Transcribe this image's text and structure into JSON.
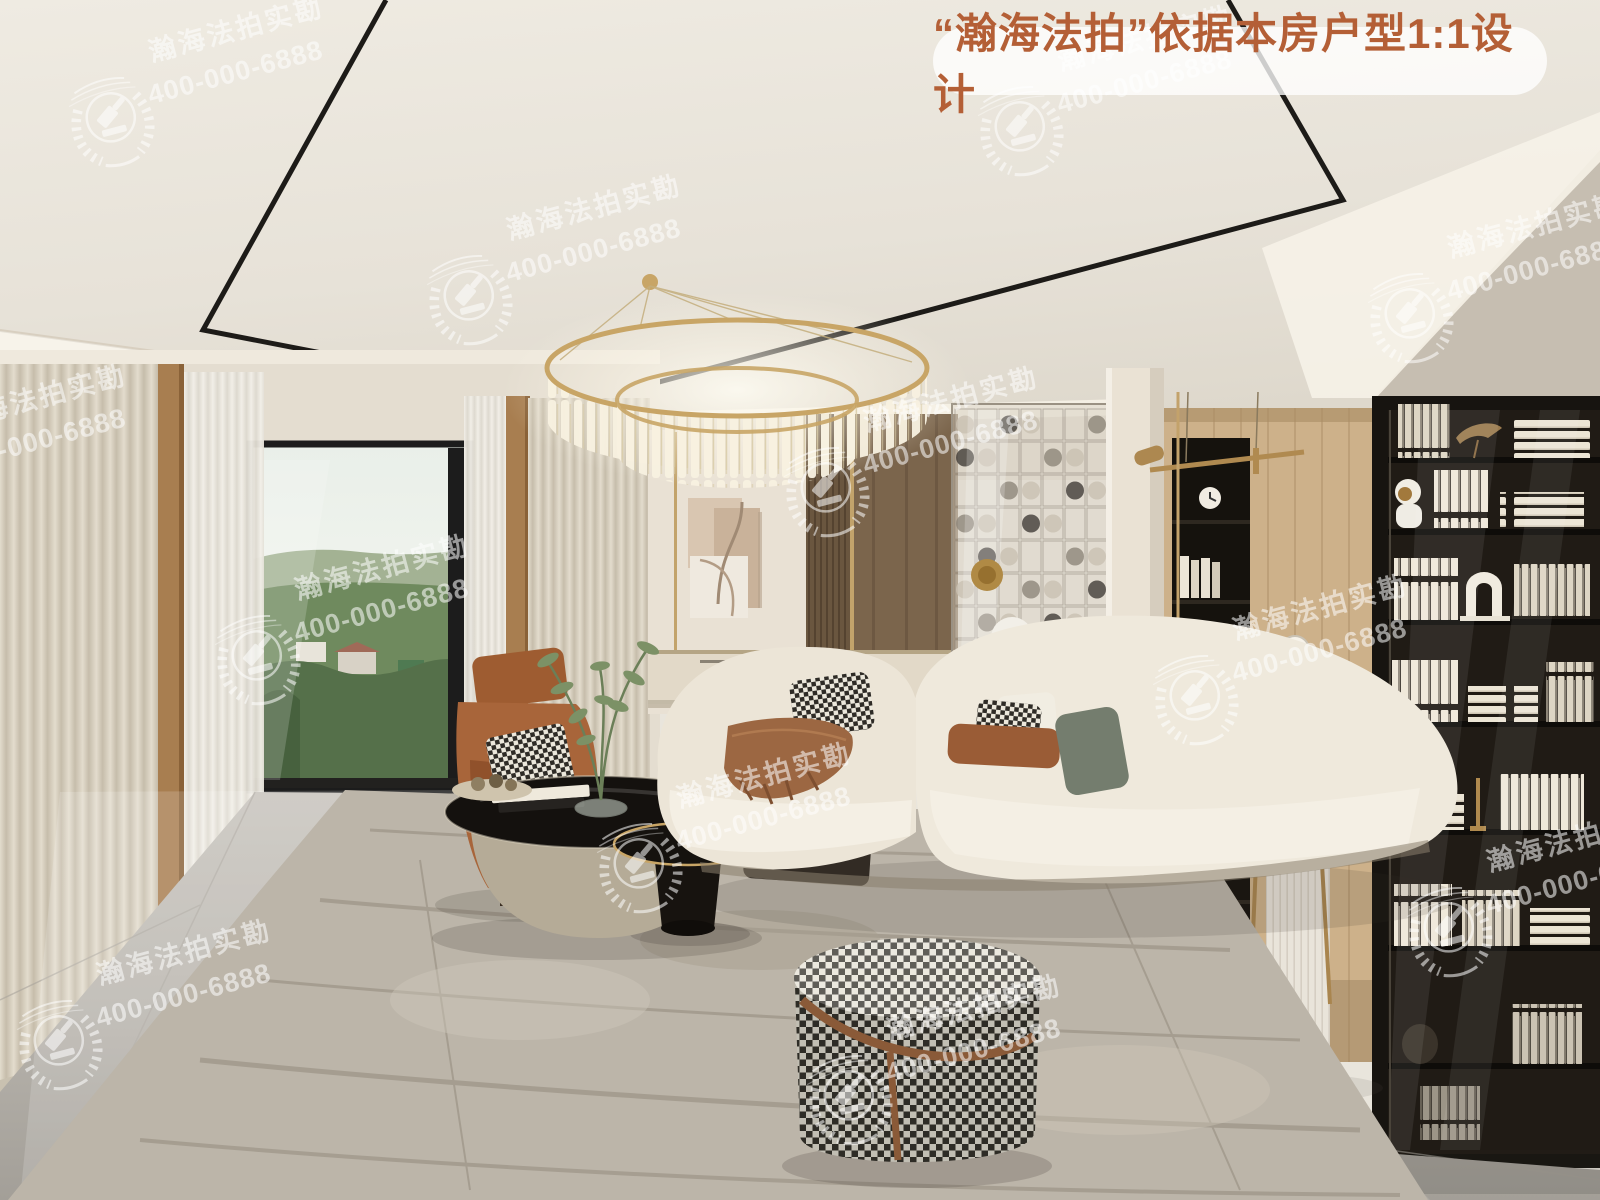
{
  "banner": {
    "text": "“瀚海法拍”依据本房户型1:1设计",
    "text_color": "#b45f36",
    "bg_color": "rgba(255,255,255,0.78)"
  },
  "watermark": {
    "brand": "瀚海法拍实勘",
    "phone": "400-000-6888",
    "logo": "laurel-wreath-gavel-icon",
    "color": "#ffffff",
    "opacity": 0.55,
    "rotation_deg": -15,
    "positions": [
      {
        "cx": 112,
        "cy": 122
      },
      {
        "cx": 1021,
        "cy": 131
      },
      {
        "cx": 470,
        "cy": 300
      },
      {
        "cx": 1411,
        "cy": 318
      },
      {
        "cx": -85,
        "cy": 490
      },
      {
        "cx": 827,
        "cy": 492
      },
      {
        "cx": 258,
        "cy": 660
      },
      {
        "cx": 1196,
        "cy": 700
      },
      {
        "cx": 640,
        "cy": 868
      },
      {
        "cx": 1450,
        "cy": 932
      },
      {
        "cx": 60,
        "cy": 1045
      },
      {
        "cx": 850,
        "cy": 1100
      }
    ]
  },
  "scene_palette": {
    "ceiling": "#e9e5dc",
    "ceiling_trim": "#1d1b18",
    "cove_light": "#f7f3ea",
    "wall_cream": "#e9e1d4",
    "wall_grey": "#c6beb1",
    "curtain_beige": "#d8d1c3",
    "curtain_sheer": "#efece5",
    "window_frame": "#1c1c1c",
    "view_green": "#6f8a5e",
    "wood_trim": "#a87e50",
    "wood_slats": "#6a563f",
    "wood_panel_right": "#cdb18a",
    "bookshelf_black": "#171410",
    "book_cream": "#efe8d9",
    "sofa_cream": "#efe9dc",
    "pillow_brown": "#9a5c36",
    "pillow_sage": "#747d6e",
    "armchair_caramel": "#a8653a",
    "throw_brown": "#9c6742",
    "table_black": "#14110e",
    "table_stone": "#b5ab97",
    "gold_accent": "#c8a566",
    "chair_olive": "#7b7f52",
    "rug_grey": "#b7afa2",
    "floor_marble": "#bdb9b2",
    "pouf_houndstooth": "#32302a"
  }
}
